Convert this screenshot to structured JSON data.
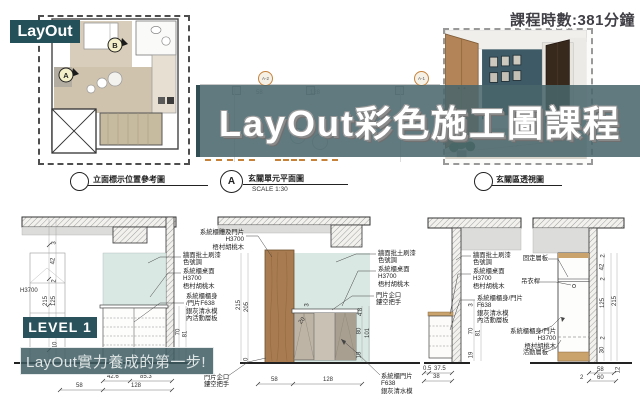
{
  "colors": {
    "teal_dark": "#24505a",
    "banner_overlay": "rgba(74,102,108,0.87)",
    "accent_orange": "#c7823a",
    "panel_teal": "#d9e8e3",
    "wood": "#a87c50"
  },
  "top": {
    "layout_badge": "LayOut",
    "duration": "課程時數:381分鐘"
  },
  "banner": {
    "title": "LayOut彩色施工圖課程"
  },
  "plan_markers": {
    "a": "A",
    "b": "B"
  },
  "mid_plan": {
    "marker_a2": "A-2",
    "marker_a1": "A-1",
    "dims": [
      "58",
      "128"
    ]
  },
  "section_labels": {
    "ref": {
      "title": "立面標示位置參考圖"
    },
    "unit": {
      "mark": "A",
      "title": "玄關單元平面圖",
      "scale": "SCALE 1:30"
    },
    "persp": {
      "title": "玄關區透視圖"
    }
  },
  "level": {
    "badge": "LEVEL 1",
    "slogan": "LayOut實力養成的第一步!"
  },
  "annotations": {
    "col1": [
      {
        "lines": [
          "系統櫃體及門片",
          "H3700",
          "梧村胡桃木"
        ]
      },
      {
        "lines": [
          "牆面批土刷漆",
          "色號調"
        ]
      },
      {
        "lines": [
          "系統櫃桌面",
          "H3700",
          "梧村胡桃木"
        ]
      },
      {
        "lines": [
          "系統櫃櫃身",
          "/門片F638",
          "銀灰清水模",
          "內活動層板"
        ]
      }
    ],
    "col2": [
      {
        "lines": [
          "牆面批土刷漆",
          "色號調"
        ]
      },
      {
        "lines": [
          "系統櫃桌面",
          "H3700",
          "梧村胡桃木"
        ]
      },
      {
        "lines": [
          "門片企口",
          "鏤空把手"
        ]
      },
      {
        "lines": [
          "系統櫃門片",
          "F638",
          "銀灰清水模"
        ]
      },
      {
        "lines": [
          "門片企口",
          "鏤空把手"
        ]
      }
    ],
    "col3": [
      {
        "lines": [
          "牆面批土刷漆",
          "色號調"
        ]
      },
      {
        "lines": [
          "系統櫃桌面",
          "H3700",
          "梧村胡桃木"
        ]
      },
      {
        "lines": [
          "系統櫃櫃身/門片",
          "F638",
          "銀灰清水模",
          "內活動層板"
        ]
      }
    ],
    "col4": [
      {
        "lines": [
          "固定層板"
        ]
      },
      {
        "lines": [
          "吊衣桿"
        ]
      },
      {
        "lines": [
          "系統櫃櫃身/門片",
          "H3700",
          "梧村胡桃木"
        ]
      },
      {
        "lines": [
          "活動層板"
        ]
      }
    ]
  },
  "dims": {
    "e1": {
      "left": [
        "3",
        "42",
        "2",
        "125",
        "10"
      ],
      "outer": "215",
      "height": "H3700",
      "right": [
        "70",
        "81"
      ],
      "bottom_upper": [
        "42.6",
        "85.3"
      ],
      "bottom_lower": [
        "58",
        "128"
      ]
    },
    "e2": {
      "left": [
        "215",
        "205",
        "10"
      ],
      "mid": [
        "3",
        "20"
      ],
      "right": [
        "4.8",
        "80",
        "101",
        "18"
      ],
      "bottom": [
        "58",
        "128"
      ]
    },
    "e3": {
      "right": [
        "3",
        "70",
        "81",
        "19"
      ],
      "bottom_upper": [
        "0.5",
        "37.5"
      ],
      "bottom_lower": "38"
    },
    "e4": {
      "right": [
        "2",
        "42",
        "2",
        "125",
        "2",
        "30"
      ],
      "outer": "215",
      "corner": "12",
      "bottom": [
        "58",
        "60",
        "2"
      ]
    }
  }
}
